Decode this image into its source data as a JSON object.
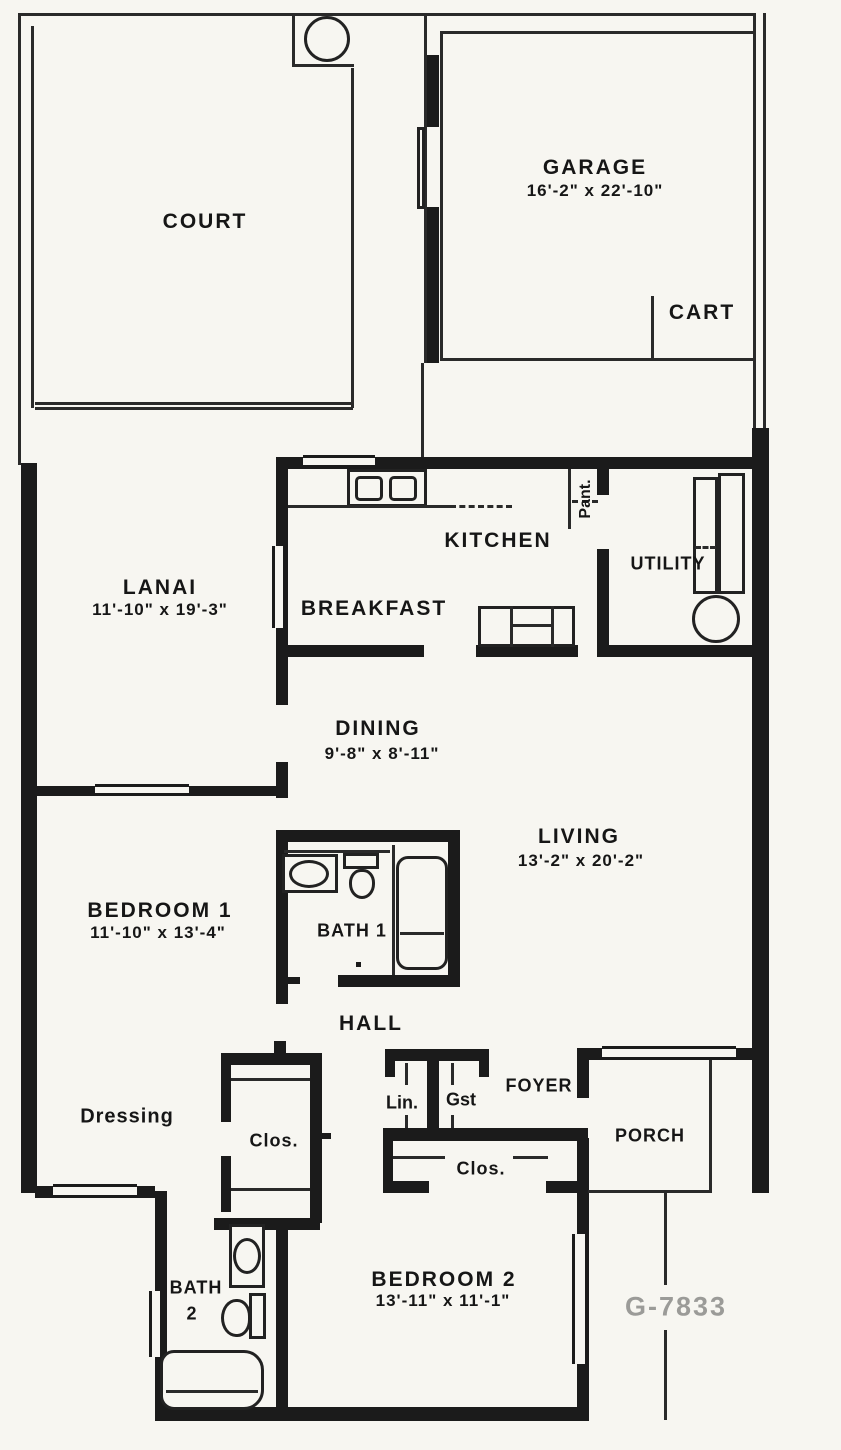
{
  "plan_number": "G-7833",
  "rooms": {
    "court": {
      "label": "COURT"
    },
    "garage": {
      "label": "GARAGE",
      "dims": "16'-2\" x 22'-10\""
    },
    "cart": {
      "label": "CART"
    },
    "lanai": {
      "label": "LANAI",
      "dims": "11'-10\" x 19'-3\""
    },
    "kitchen": {
      "label": "KITCHEN"
    },
    "pantry": {
      "label": "Pant."
    },
    "utility": {
      "label": "UTILITY"
    },
    "breakfast": {
      "label": "BREAKFAST"
    },
    "dining": {
      "label": "DINING",
      "dims": "9'-8\" x 8'-11\""
    },
    "living": {
      "label": "LIVING",
      "dims": "13'-2\" x 20'-2\""
    },
    "bedroom1": {
      "label": "BEDROOM 1",
      "dims": "11'-10\" x 13'-4\""
    },
    "bath1": {
      "label": "BATH 1"
    },
    "hall": {
      "label": "HALL"
    },
    "dressing": {
      "label": "Dressing"
    },
    "closet_walkin": {
      "label": "Clos."
    },
    "linen": {
      "label": "Lin."
    },
    "guest": {
      "label": "Gst"
    },
    "foyer": {
      "label": "FOYER"
    },
    "closet_foyer": {
      "label": "Clos."
    },
    "porch": {
      "label": "PORCH"
    },
    "bath2": {
      "label": "BATH",
      "number": "2"
    },
    "bedroom2": {
      "label": "BEDROOM 2",
      "dims": "13'-11\" x 11'-1\""
    }
  },
  "colors": {
    "wall": "#1b1b1b",
    "paper": "#f7f6f1",
    "plan_number": "#9b9b98"
  }
}
